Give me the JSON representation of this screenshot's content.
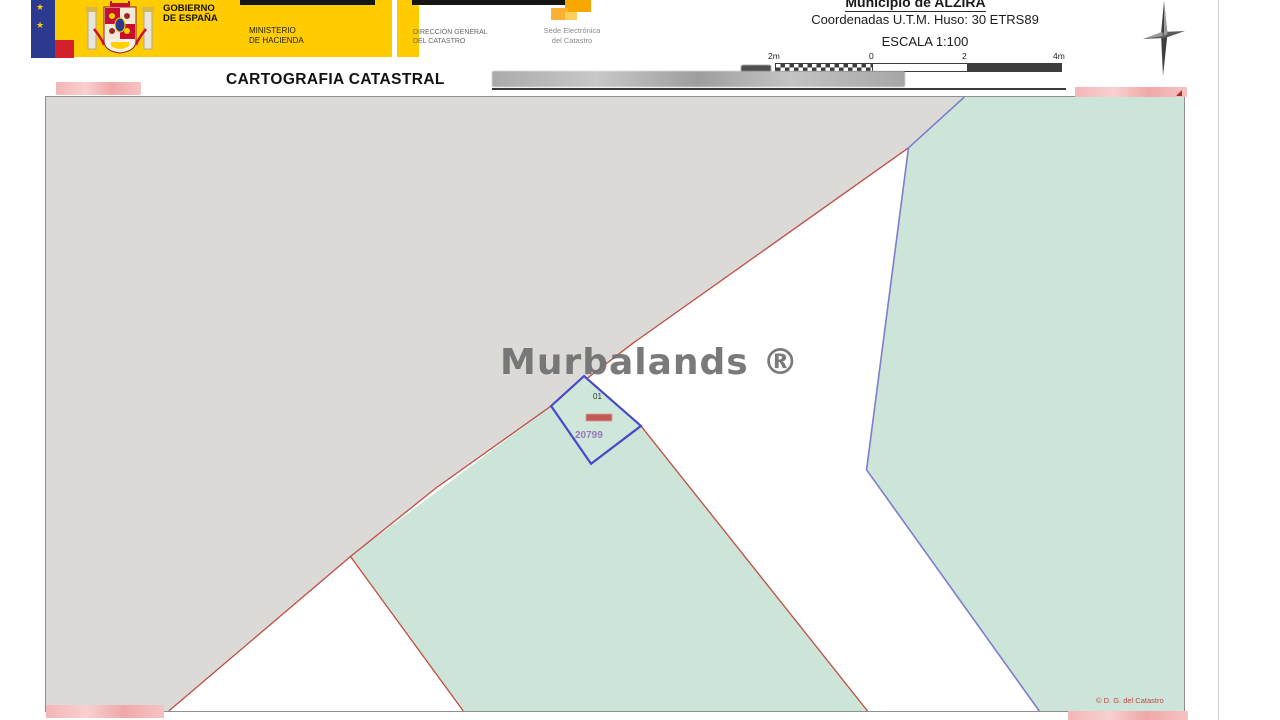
{
  "header": {
    "government": {
      "line1": "GOBIERNO",
      "line2": "DE ESPAÑA"
    },
    "ministry": {
      "line1": "MINISTERIO",
      "line2": "DE HACIENDA"
    },
    "direccion": {
      "line1": "DIRECCIÓN GENERAL",
      "line2": "DEL CATASTRO"
    },
    "sede": {
      "line1": "Sede Electrónica",
      "line2": "del Catastro"
    },
    "municipio": "Municipio de ALZIRA",
    "coordinates": "Coordenadas U.T.M. Huso: 30 ETRS89",
    "escala": "ESCALA 1:100",
    "scale_bar": {
      "labels": [
        "2m",
        "0",
        "2",
        "4m"
      ]
    }
  },
  "title_bar": {
    "title": "CARTOGRAFIA CATASTRAL"
  },
  "map": {
    "watermark": "Murbalands ®",
    "parcel": {
      "sub_label": "01",
      "number": "20799"
    },
    "copyright": "© D. G. del Catastro"
  },
  "icons": {
    "star_glyph": "★"
  },
  "colors": {
    "banner_yellow": "#ffcc00",
    "eu_blue": "#2b3990",
    "flag_red": "#d3212c",
    "map_gray_region": "#dbdad7",
    "map_green_region": "#cde4d9",
    "boundary_red": "#c14b41",
    "boundary_blue": "#7d7dcb",
    "parcel_outline_blue": "#4949c9",
    "redaction_pink": "#f4b6b6",
    "watermark_gray": "#6f6f6f"
  }
}
